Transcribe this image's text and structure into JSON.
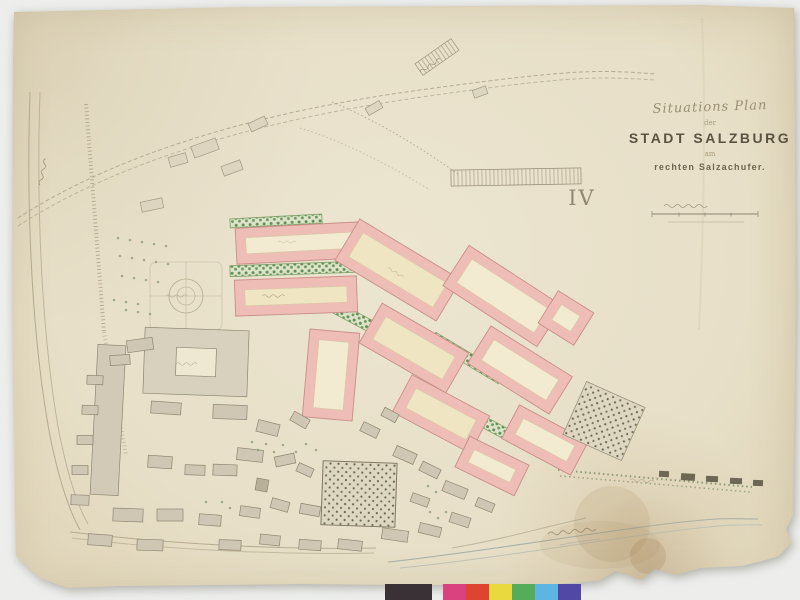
{
  "sheet": {
    "number": "IV",
    "paper_color": "#e9e1ca",
    "background_color": "#edeeec"
  },
  "title_block": {
    "script_title": "Situations Plan",
    "connector1": "der",
    "main_title": "STADT SALZBURG",
    "connector2": "am",
    "subtitle": "rechten Salzachufer."
  },
  "color_bar": {
    "patches": [
      {
        "name": "dark-gray",
        "hex": "#3a3137"
      },
      {
        "name": "magenta",
        "hex": "#d9417f"
      },
      {
        "name": "red",
        "hex": "#dd4532"
      },
      {
        "name": "yellow",
        "hex": "#e9d93f"
      },
      {
        "name": "green",
        "hex": "#55ad5a"
      },
      {
        "name": "cyan",
        "hex": "#5cb5e2"
      },
      {
        "name": "violet",
        "hex": "#5148a5"
      }
    ]
  },
  "map_palette": {
    "planned_block_outline": "#edbdb6",
    "planned_block_interior": "#f3ebd1",
    "tree_avenue_green": "#5f8f55",
    "building_gray": "#cfc7b3",
    "ink": "#8f8672",
    "river": "#9fa8a2"
  }
}
